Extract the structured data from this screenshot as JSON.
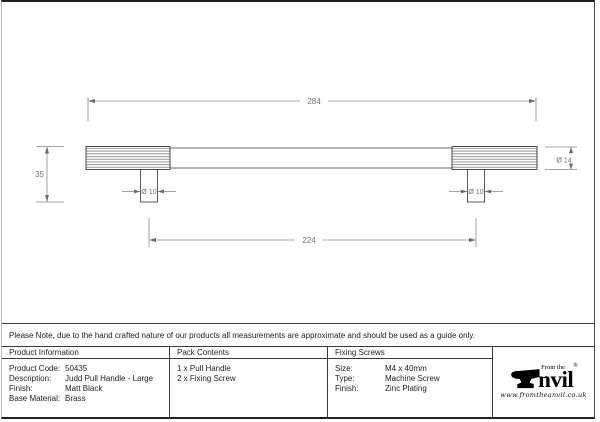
{
  "drawing": {
    "dim_overall_length": "284",
    "dim_fixing_centers": "224",
    "dim_projection": "35",
    "dim_end_diameter": "Ø 14",
    "dim_post_diameter_left": "Ø 10",
    "dim_post_diameter_right": "Ø 10"
  },
  "note": {
    "text": "Please Note, due to the hand crafted nature of our products all measurements are approximate and should be used as a guide only."
  },
  "info_table": {
    "product_information": {
      "header": "Product Information",
      "rows": [
        {
          "label": "Product Code:",
          "value": "50435"
        },
        {
          "label": "Description:",
          "value": "Judd Pull Handle - Large"
        },
        {
          "label": "Finish:",
          "value": "Matt Black"
        },
        {
          "label": "Base Material:",
          "value": "Brass"
        }
      ]
    },
    "pack_contents": {
      "header": "Pack Contents",
      "items": [
        "1 x Pull Handle",
        "2 x Fixing Screw"
      ]
    },
    "fixing_screws": {
      "header": "Fixing Screws",
      "rows": [
        {
          "label": "Size:",
          "value": "M4 x 40mm"
        },
        {
          "label": "Type:",
          "value": "Machine Screw"
        },
        {
          "label": "Finish:",
          "value": "Zinc Plating"
        }
      ]
    }
  },
  "logo": {
    "tagline": "From the",
    "brand_suffix": "nvil",
    "registered_mark": "®",
    "website": "www.fromtheanvil.co.uk"
  },
  "colors": {
    "object_line": "#4a4a4a",
    "dimension_line": "#8a8a8a",
    "table_border": "#333333",
    "text": "#1f1f1f"
  }
}
